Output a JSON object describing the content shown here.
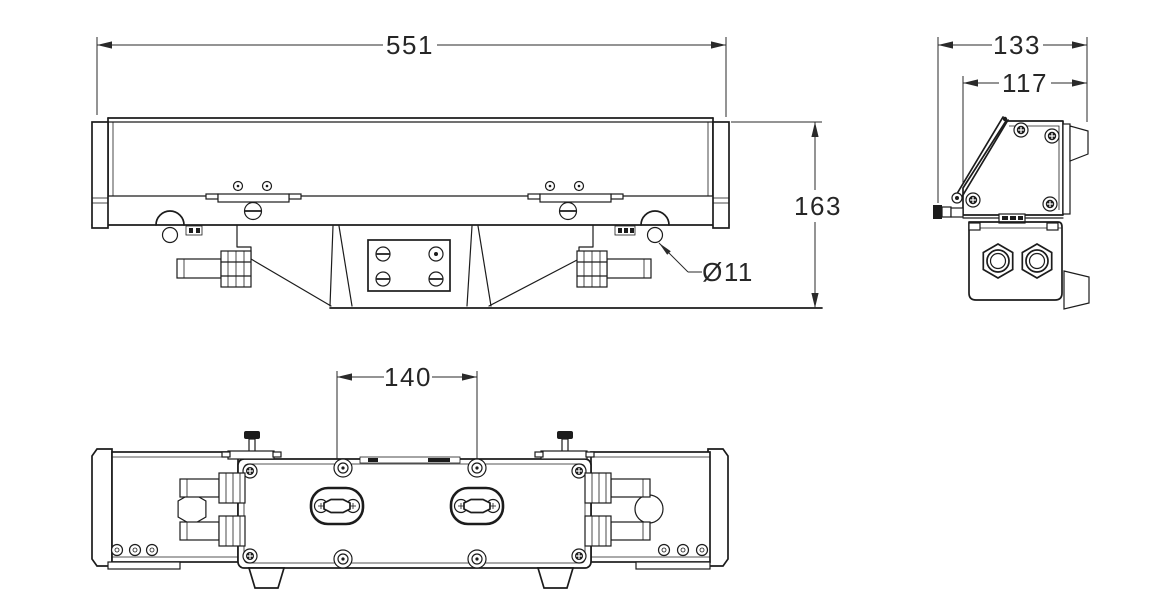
{
  "dimensions": {
    "front_width": "551",
    "front_height": "163",
    "eye_hole": "Ø11",
    "side_overall": "133",
    "side_body": "117",
    "slot_spacing": "140"
  },
  "colors": {
    "line": "#1c1c1c",
    "dim": "#2a2a2a",
    "bg": "#ffffff"
  }
}
